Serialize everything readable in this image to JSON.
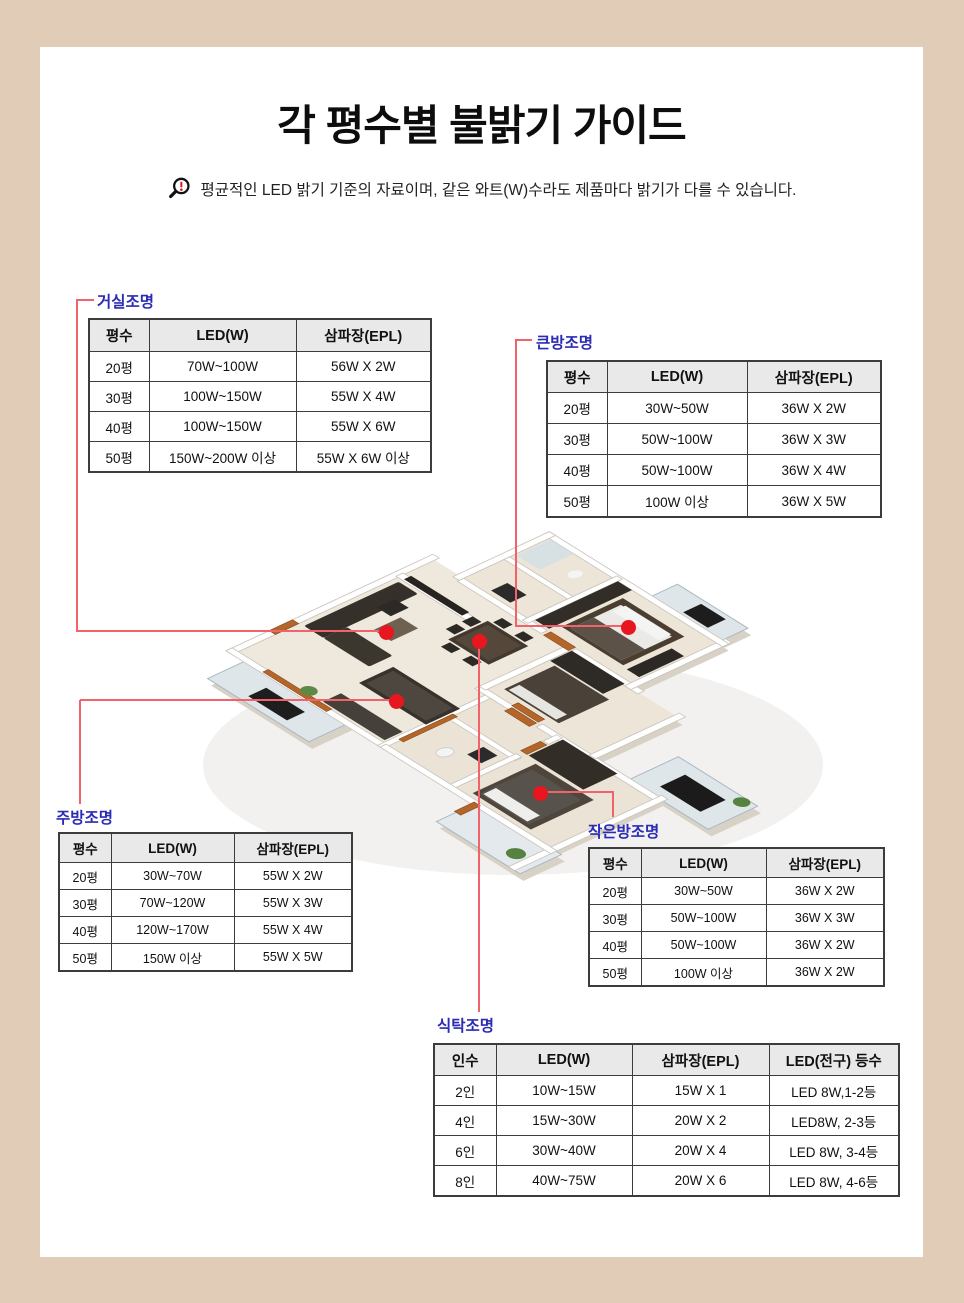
{
  "page": {
    "title": "각 평수별 불밝기 가이드",
    "disclaimer": "평균적인 LED 밝기 기준의 자료이며, 같은 와트(W)수라도 제품마다 밝기가 다를 수 있습니다."
  },
  "colors": {
    "page_bg": "#e1ccb8",
    "accent_line": "#f2626a",
    "dot_red": "#e8161f",
    "label_blue": "#2b2bb4",
    "table_border": "#3c3c3c",
    "header_bg": "#e9e9e9"
  },
  "tables": {
    "living": {
      "label": "거실조명",
      "headers": [
        "평수",
        "LED(W)",
        "삼파장(EPL)"
      ],
      "rows": [
        [
          "20평",
          "70W~100W",
          "56W X 2W"
        ],
        [
          "30평",
          "100W~150W",
          "55W X 4W"
        ],
        [
          "40평",
          "100W~150W",
          "55W X 6W"
        ],
        [
          "50평",
          "150W~200W 이상",
          "55W X 6W 이상"
        ]
      ]
    },
    "bigroom": {
      "label": "큰방조명",
      "headers": [
        "평수",
        "LED(W)",
        "삼파장(EPL)"
      ],
      "rows": [
        [
          "20평",
          "30W~50W",
          "36W X 2W"
        ],
        [
          "30평",
          "50W~100W",
          "36W X 3W"
        ],
        [
          "40평",
          "50W~100W",
          "36W X 4W"
        ],
        [
          "50평",
          "100W 이상",
          "36W X 5W"
        ]
      ]
    },
    "kitchen": {
      "label": "주방조명",
      "headers": [
        "평수",
        "LED(W)",
        "삼파장(EPL)"
      ],
      "rows": [
        [
          "20평",
          "30W~70W",
          "55W X 2W"
        ],
        [
          "30평",
          "70W~120W",
          "55W X 3W"
        ],
        [
          "40평",
          "120W~170W",
          "55W X 4W"
        ],
        [
          "50평",
          "150W 이상",
          "55W X 5W"
        ]
      ]
    },
    "smallroom": {
      "label": "작은방조명",
      "headers": [
        "평수",
        "LED(W)",
        "삼파장(EPL)"
      ],
      "rows": [
        [
          "20평",
          "30W~50W",
          "36W X 2W"
        ],
        [
          "30평",
          "50W~100W",
          "36W X 3W"
        ],
        [
          "40평",
          "50W~100W",
          "36W X 2W"
        ],
        [
          "50평",
          "100W 이상",
          "36W X 2W"
        ]
      ]
    },
    "dining": {
      "label": "식탁조명",
      "headers": [
        "인수",
        "LED(W)",
        "삼파장(EPL)",
        "LED(전구) 등수"
      ],
      "rows": [
        [
          "2인",
          "10W~15W",
          "15W X 1",
          "LED 8W,1-2등"
        ],
        [
          "4인",
          "15W~30W",
          "20W X 2",
          "LED8W, 2-3등"
        ],
        [
          "6인",
          "30W~40W",
          "20W X 4",
          "LED 8W, 3-4등"
        ],
        [
          "8인",
          "40W~75W",
          "20W X 6",
          "LED 8W, 4-6등"
        ]
      ]
    }
  }
}
